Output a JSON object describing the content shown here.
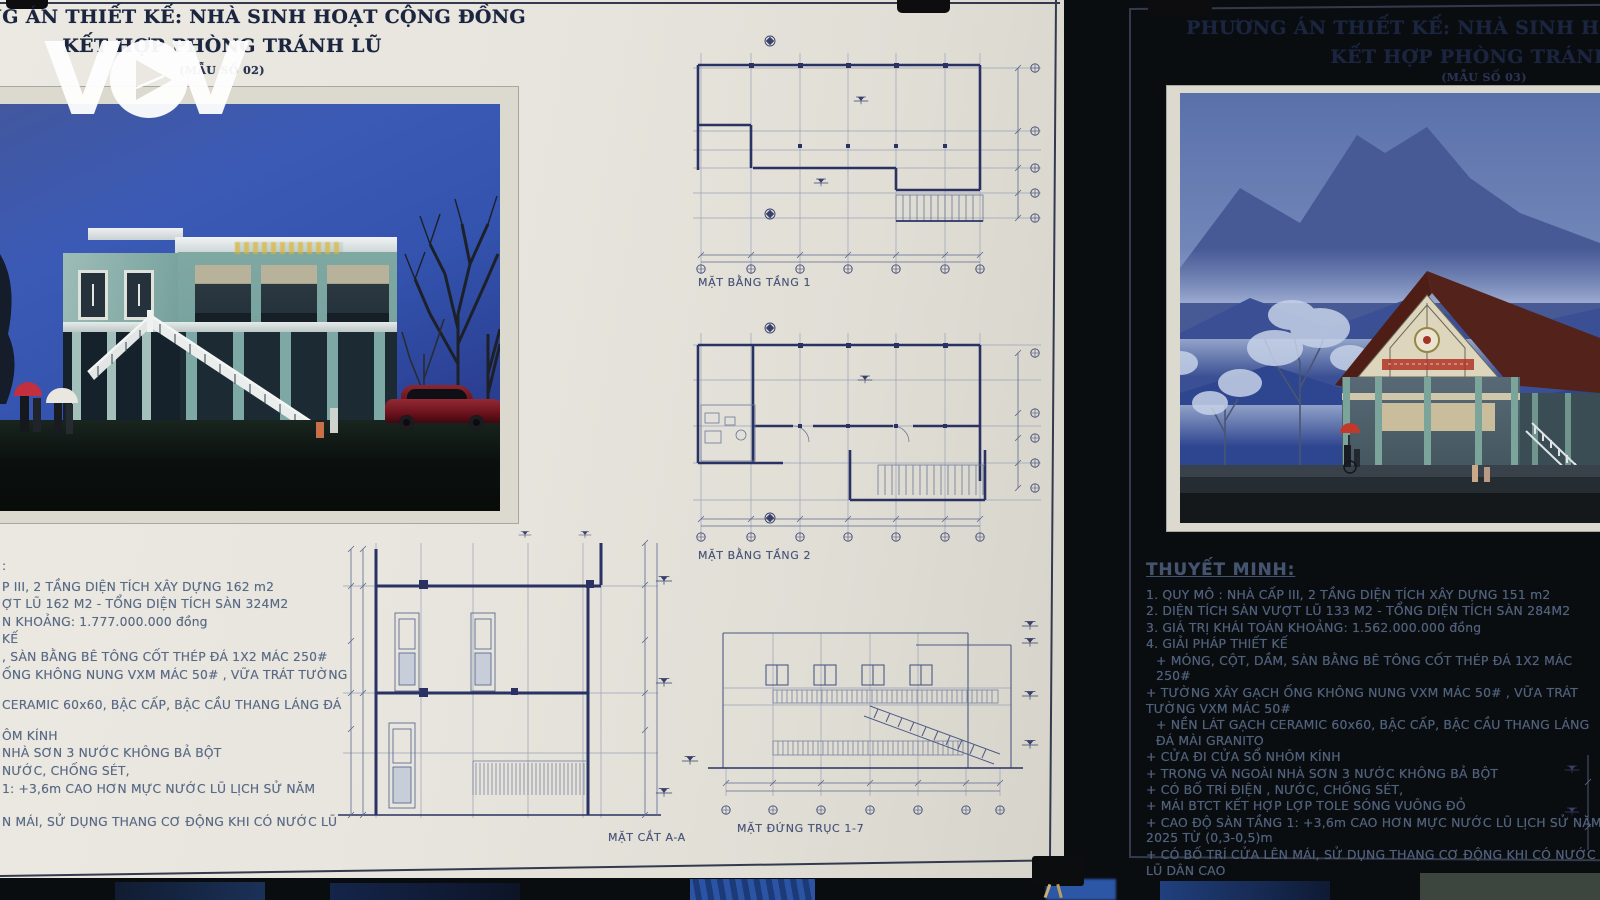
{
  "logo": {
    "name": "VOV",
    "v1": "V",
    "v2": "V"
  },
  "left_poster": {
    "title_line1": "PHƯƠNG ÁN THIẾT KẾ: NHÀ SINH HOẠT CỘNG ĐỒNG",
    "title_line2": "KẾT HỢP PHÒNG TRÁNH LŨ",
    "title_line3": "(MẪU SỐ 02)",
    "specs": [
      ":",
      "P III, 2 TẦNG DIỆN TÍCH XÂY DỰNG 162 m2",
      "ỢT LŨ 162 M2 - TỔNG DIỆN TÍCH SÀN 324M2",
      "N KHOẢNG: 1.777.000.000 đồng",
      "KẾ",
      ", SÀN BẰNG BÊ TÔNG CỐT THÉP ĐÁ 1X2 MÁC 250#",
      "ỐNG KHÔNG NUNG VXM MÁC 50# , VỮA TRÁT TƯỜNG",
      "CERAMIC 60x60, BẬC CẤP, BẬC CẦU THANG LÁNG ĐÁ",
      "ÔM KÍNH",
      "NHÀ SƠN 3 NƯỚC KHÔNG BẢ BỘT",
      "NƯỚC, CHỐNG SÉT,",
      "1: +3,6m CAO HƠN MỰC NƯỚC LŨ LỊCH SỬ NĂM",
      "N MÁI, SỬ DỤNG THANG CƠ ĐỘNG KHI CÓ NƯỚC LŨ"
    ],
    "labels": {
      "plan1": "MẶT BẰNG TẦNG 1",
      "plan2": "MẶT BẰNG TẦNG 2",
      "section": "MẶT CẮT A-A",
      "elevation": "MẶT ĐỨNG TRỤC 1-7"
    }
  },
  "right_poster": {
    "title_line1": "PHƯƠNG ÁN THIẾT KẾ: NHÀ SINH HOẠT CỘNG ĐỒNG",
    "title_line2": "KẾT HỢP PHÒNG TRÁNH LŨ",
    "title_line3": "(MẪU SỐ 03)",
    "notes_heading": "THUYẾT MINH:",
    "notes": [
      "1. QUY MÔ : NHÀ CẤP III, 2 TẦNG DIỆN TÍCH XÂY DỰNG 151 m2",
      "2. DIỆN TÍCH SÀN VƯỢT LŨ 133 M2 - TỔNG DIỆN TÍCH SÀN 284M2",
      "3. GIÁ TRỊ KHÁI TOÁN KHOẢNG: 1.562.000.000 đồng",
      "4. GIẢI PHÁP THIẾT KẾ",
      "+ MÓNG, CỘT, DẦM, SÀN BẰNG BÊ TÔNG CỐT THÉP ĐÁ 1X2 MÁC 250#",
      "+ TƯỜNG XÂY GẠCH ỐNG KHÔNG NUNG VXM MÁC 50# , VỮA TRÁT TƯỜNG VXM MÁC 50#",
      "+ NỀN LÁT GẠCH CERAMIC 60x60, BẬC CẤP, BẬC CẦU THANG LÁNG ĐÁ MÀI GRANITO",
      "+ CỬA ĐI CỬA SỔ NHÔM KÍNH",
      "+ TRONG VÀ NGOÀI NHÀ SƠN 3 NƯỚC KHÔNG BẢ BỘT",
      "+ CÓ BỐ TRÍ ĐIỆN , NƯỚC, CHỐNG SÉT,",
      "+ MÁI BTCT KẾT HỢP LỢP TOLE SÓNG VUÔNG ĐỎ",
      "+ CAO ĐỘ SÀN TẦNG 1: +3,6m CAO HƠN MỰC NƯỚC LŨ LỊCH SỬ NĂM 2025 TỪ (0,3-0,5)m",
      "+ CÓ BỐ TRÍ CỬA LÊN MÁI, SỬ DỤNG THANG CƠ ĐỘNG KHI CÓ NƯỚC LŨ DÂN CAO"
    ]
  },
  "colors": {
    "paper": "#e9e6de",
    "sky_blue": "#3b58b0",
    "building_teal": "#7ea8a3",
    "roof_maroon": "#4f1d16",
    "car_red": "#7a1722",
    "title_ink": "#1b2540",
    "drawing_ink": "#2a3263"
  }
}
